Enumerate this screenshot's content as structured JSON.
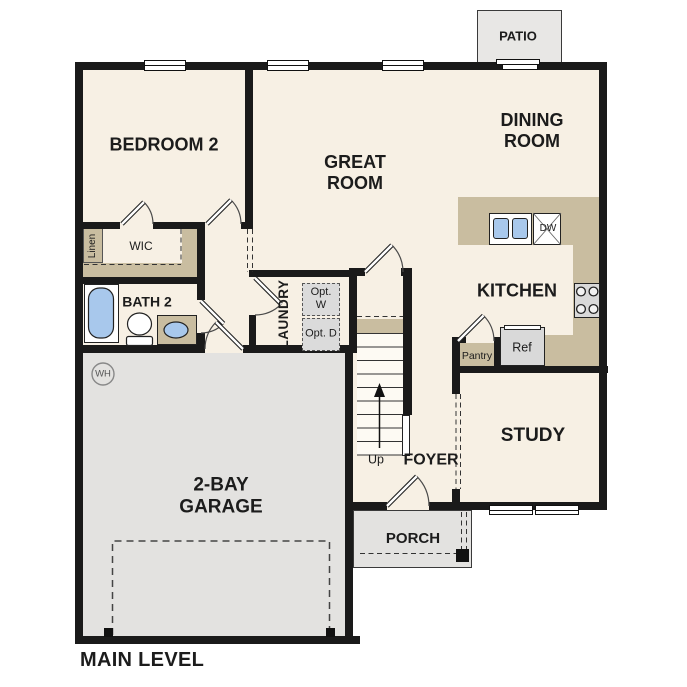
{
  "plan_title": "MAIN LEVEL",
  "labels": {
    "patio": "PATIO",
    "dining_room": "DINING ROOM",
    "great_room": "GREAT ROOM",
    "bedroom_2": "BEDROOM 2",
    "kitchen": "KITCHEN",
    "study": "STUDY",
    "foyer": "FOYER",
    "porch": "PORCH",
    "garage": "2-BAY GARAGE",
    "main_level": "MAIN LEVEL",
    "bath_2": "BATH 2",
    "wic": "WIC",
    "linen": "Linen",
    "laundry": "LAUNDRY",
    "opt_w": "Opt. W",
    "opt_d": "Opt. D",
    "pantry": "Pantry",
    "ref": "Ref",
    "dw": "DW",
    "wh": "WH",
    "up": "Up"
  },
  "colors": {
    "floor": "#f7f0e4",
    "wall": "#1a1a1a",
    "counter_tan": "#c9bda0",
    "outdoor_gray": "#e3e2e0",
    "fixture_blue": "#a8c8ec",
    "appliance_gray": "#d9d9d9",
    "dashed_line": "#333333"
  }
}
